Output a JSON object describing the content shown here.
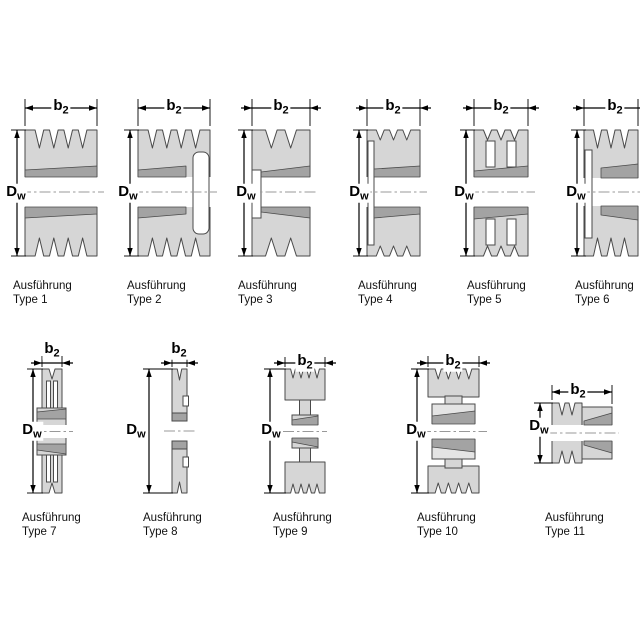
{
  "diagram": {
    "background": "#ffffff"
  },
  "dimension_labels": {
    "width": {
      "main": "b",
      "sub": "2"
    },
    "diameter": {
      "main": "D",
      "sub": "w"
    }
  },
  "figures": [
    {
      "caption_line1": "Ausführung",
      "caption_line2": "Type 1"
    },
    {
      "caption_line1": "Ausführung",
      "caption_line2": "Type 2"
    },
    {
      "caption_line1": "Ausführung",
      "caption_line2": "Type 3"
    },
    {
      "caption_line1": "Ausführung",
      "caption_line2": "Type 4"
    },
    {
      "caption_line1": "Ausführung",
      "caption_line2": "Type 5"
    },
    {
      "caption_line1": "Ausführung",
      "caption_line2": "Type 6"
    },
    {
      "caption_line1": "Ausführung",
      "caption_line2": "Type 7"
    },
    {
      "caption_line1": "Ausführung",
      "caption_line2": "Type 8"
    },
    {
      "caption_line1": "Ausführung",
      "caption_line2": "Type 9"
    },
    {
      "caption_line1": "Ausführung",
      "caption_line2": "Type 10"
    },
    {
      "caption_line1": "Ausführung",
      "caption_line2": "Type 11"
    }
  ],
  "colors": {
    "body": "#d6d6d6",
    "band": "#a3a3a3",
    "hub": "#e4e4e4",
    "white": "#ffffff",
    "outline": "#4a4a4a",
    "dim": "#000000",
    "centerline": "#999999"
  }
}
